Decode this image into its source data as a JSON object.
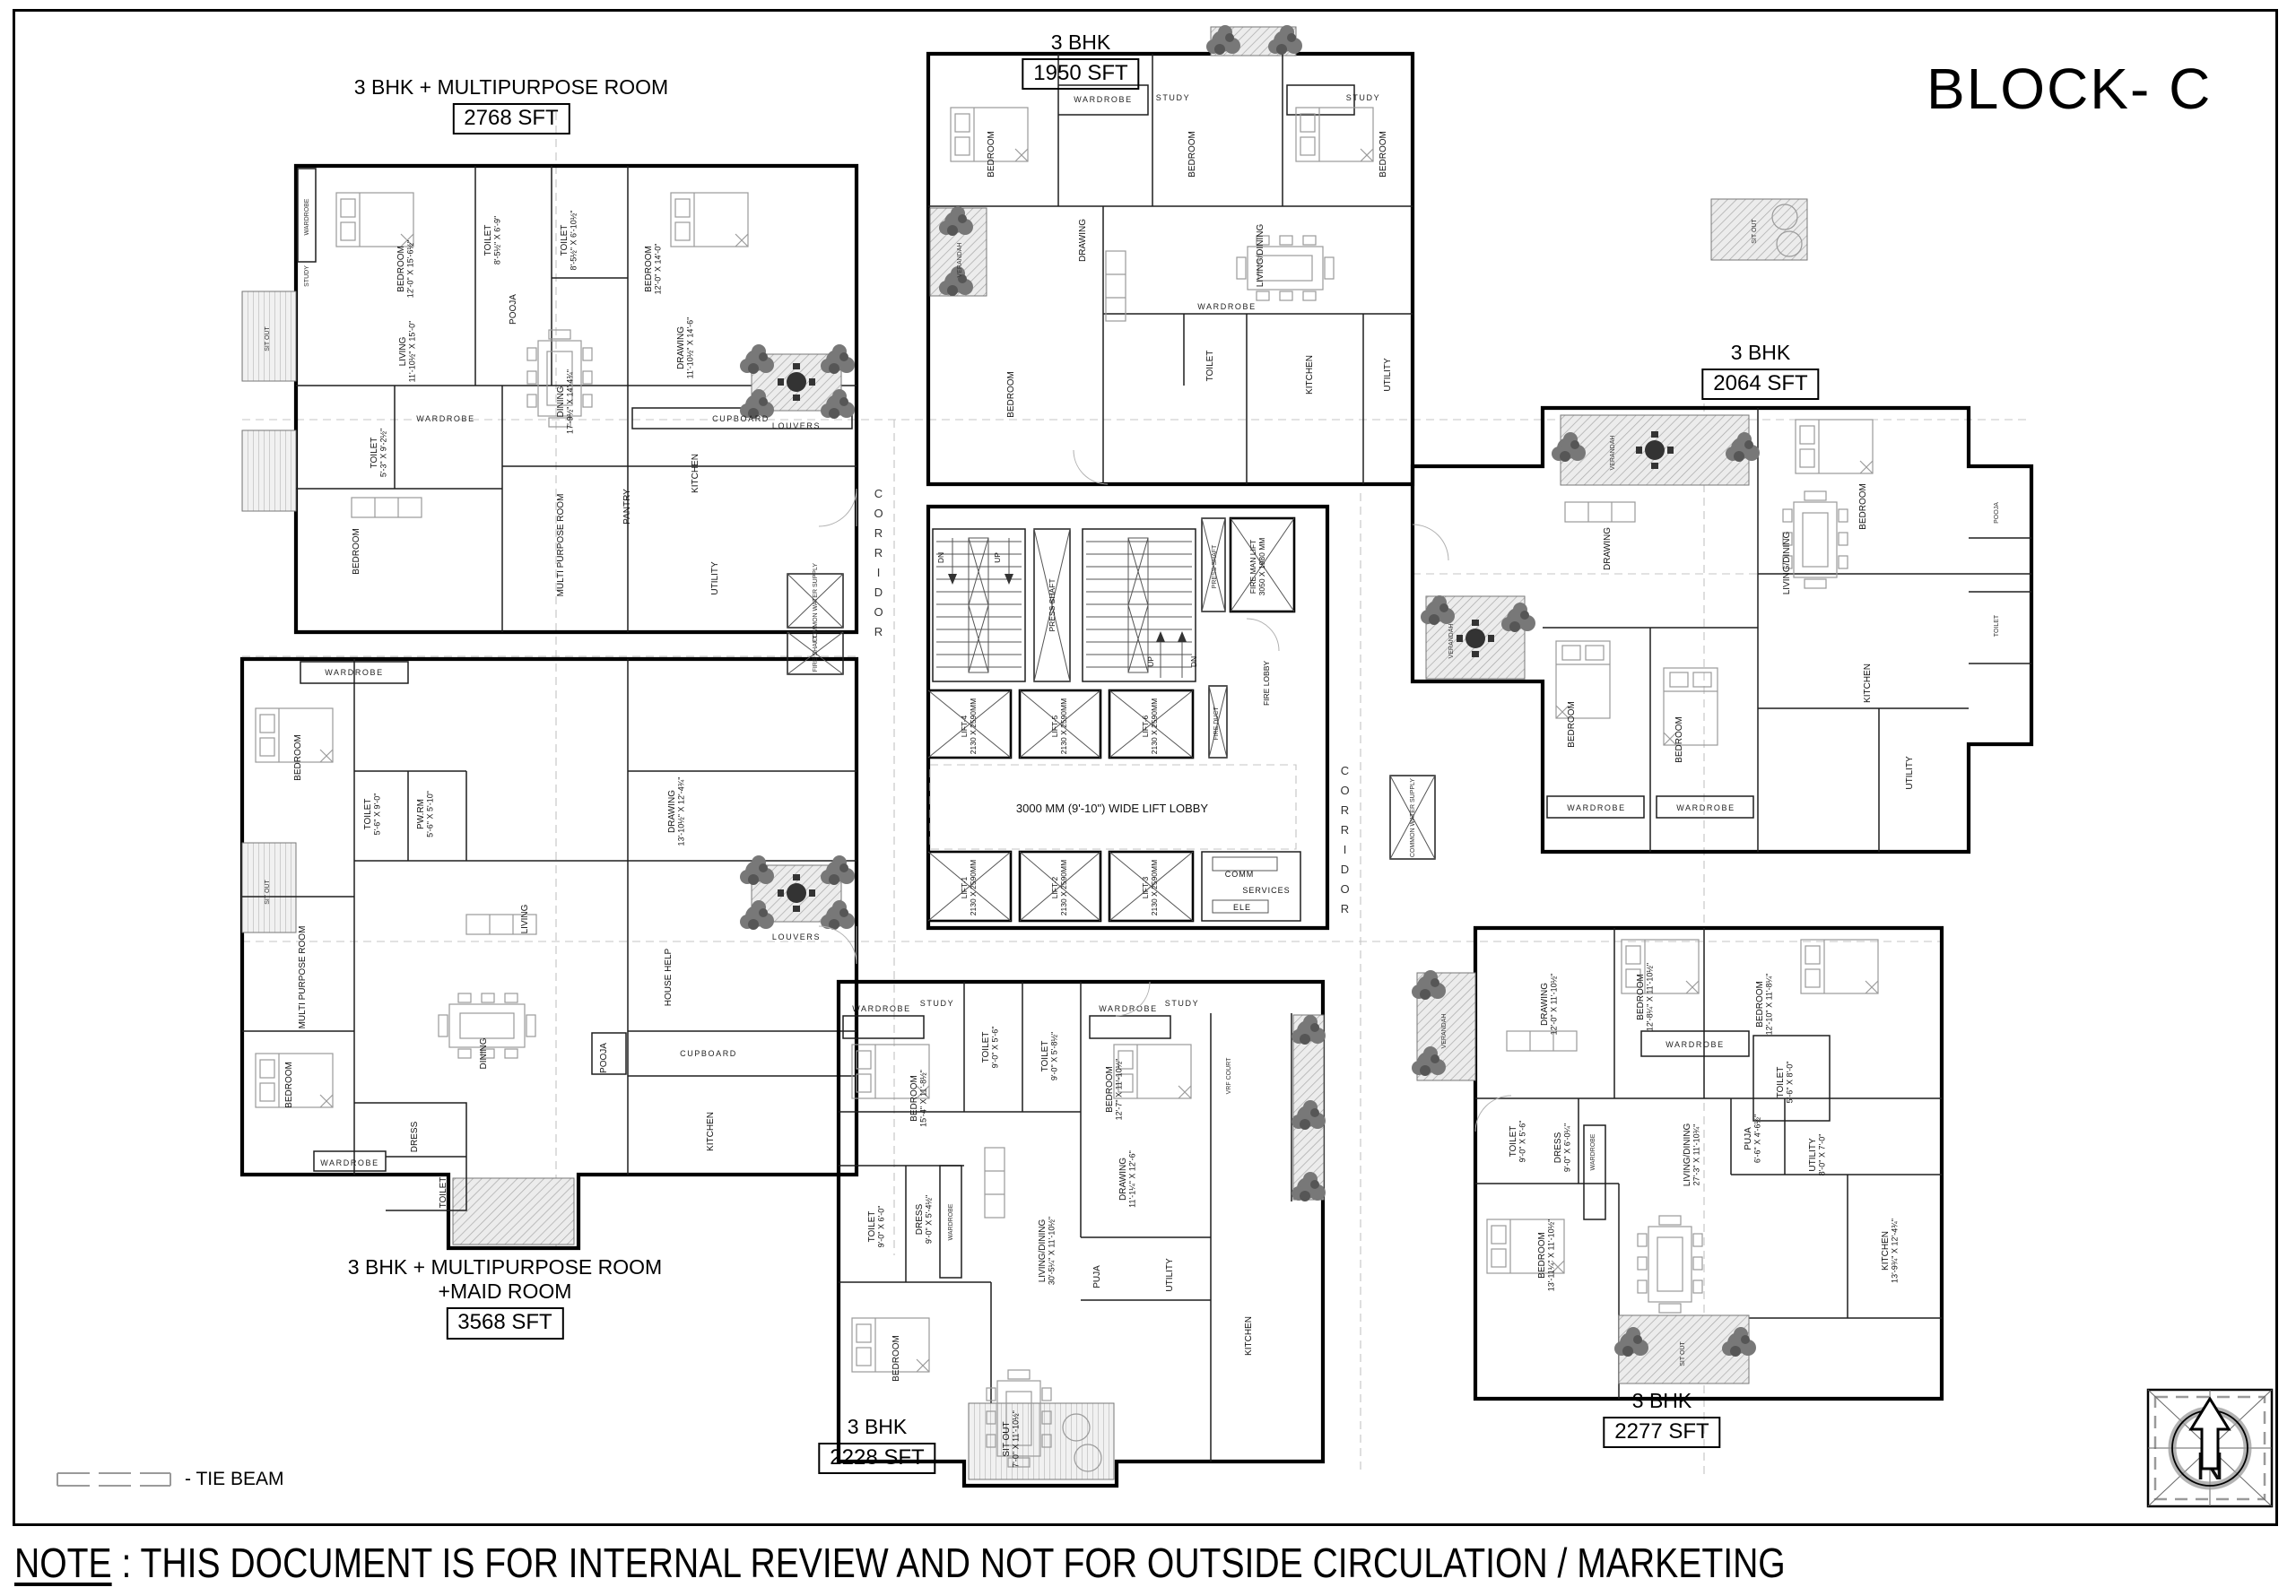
{
  "title": "BLOCK- C",
  "note": {
    "prefix": "NOTE",
    "text": " : THIS DOCUMENT IS FOR INTERNAL REVIEW AND NOT FOR OUTSIDE CIRCULATION / MARKETING"
  },
  "legend": {
    "tie_beam": "- TIE BEAM"
  },
  "compass": {
    "north": "N"
  },
  "unit_labels": {
    "u1": {
      "line1": "3 BHK + MULTIPURPOSE ROOM",
      "sft": "2768 SFT"
    },
    "u2": {
      "line1": "3 BHK + MULTIPURPOSE ROOM",
      "line2": "+MAID ROOM",
      "sft": "3568 SFT"
    },
    "u3": {
      "line1": "3 BHK",
      "sft": "1950 SFT"
    },
    "u4": {
      "line1": "3 BHK",
      "sft": "2064 SFT"
    },
    "u5": {
      "line1": "3 BHK",
      "sft": "2228 SFT"
    },
    "u6": {
      "line1": "3 BHK",
      "sft": "2277 SFT"
    }
  },
  "core": {
    "press_shaft": "PRESS SHAFT",
    "fire_man_lift": "FIRE MAN LIFT",
    "fire_man_lift_size": "3050 X 1980 MM",
    "fire_lobby": "FIRE LOBBY",
    "fire_duct": "FIRE DUCT",
    "lobby": "3000 MM (9'-10\") WIDE LIFT LOBBY",
    "corridor": "CORRIDOR",
    "common_water_supply": "COMMON WATER SUPPLY",
    "fire_shaft": "FIRE SHAFT",
    "comm": "COMM",
    "services": "SERVICES",
    "ele": "ELE",
    "up": "UP",
    "dn": "DN",
    "lifts": [
      {
        "name": "LIFT-1",
        "size": "2130 X 2590MM"
      },
      {
        "name": "LIFT-2",
        "size": "2130 X 2590MM"
      },
      {
        "name": "LIFT-3",
        "size": "2130 X 2590MM"
      },
      {
        "name": "LIFT-4",
        "size": "2130 X 2590MM"
      },
      {
        "name": "LIFT-5",
        "size": "2130 X 2590MM"
      },
      {
        "name": "LIFT-6",
        "size": "2130 X 2590MM"
      }
    ]
  },
  "rooms": {
    "u1": [
      {
        "name": "BEDROOM",
        "dim": "12'-0\" X 15'-6½\""
      },
      {
        "name": "TOILET",
        "dim": "8'-5½\" X 6'-9\""
      },
      {
        "name": "POOJA",
        "dim": ""
      },
      {
        "name": "TOILET",
        "dim": "8'-5½\" X 6'-10½\""
      },
      {
        "name": "BEDROOM",
        "dim": "12'-0\" X 14'-0\""
      },
      {
        "name": "LIVING",
        "dim": "11'-10½\" X 15'-0\""
      },
      {
        "name": "DINING",
        "dim": "17'-9½\" X 14'-4¾\""
      },
      {
        "name": "DRAWING",
        "dim": "11'-10½\" X 14'-6\""
      },
      {
        "name": "WARDROBE",
        "dim": ""
      },
      {
        "name": "STUDY",
        "dim": ""
      },
      {
        "name": "WARDROBE",
        "dim": ""
      },
      {
        "name": "TOILET",
        "dim": "5'-3\" X 9'-2½\""
      },
      {
        "name": "BEDROOM",
        "dim": ""
      },
      {
        "name": "MULTI PURPOSE ROOM",
        "dim": ""
      },
      {
        "name": "PANTRY",
        "dim": ""
      },
      {
        "name": "KITCHEN",
        "dim": ""
      },
      {
        "name": "CUPBOARD",
        "dim": ""
      },
      {
        "name": "UTILITY",
        "dim": ""
      },
      {
        "name": "SIT OUT",
        "dim": ""
      },
      {
        "name": "LOUVERS",
        "dim": ""
      }
    ],
    "u2": [
      {
        "name": "WARDROBE",
        "dim": ""
      },
      {
        "name": "BEDROOM",
        "dim": ""
      },
      {
        "name": "TOILET",
        "dim": "5'-6\" X 9'-0\""
      },
      {
        "name": "PW.RM",
        "dim": "5'-6\" X 5'-10\""
      },
      {
        "name": "DRAWING",
        "dim": "13'-10½\" X 12'-4¾\""
      },
      {
        "name": "MULTI PURPOSE ROOM",
        "dim": ""
      },
      {
        "name": "LIVING",
        "dim": ""
      },
      {
        "name": "HOUSE HELP",
        "dim": ""
      },
      {
        "name": "DINING",
        "dim": ""
      },
      {
        "name": "POOJA",
        "dim": ""
      },
      {
        "name": "CUPBOARD",
        "dim": ""
      },
      {
        "name": "KITCHEN",
        "dim": ""
      },
      {
        "name": "BEDROOM",
        "dim": ""
      },
      {
        "name": "DRESS",
        "dim": ""
      },
      {
        "name": "TOILET",
        "dim": ""
      },
      {
        "name": "WARDROBE",
        "dim": ""
      },
      {
        "name": "SIT OUT",
        "dim": ""
      },
      {
        "name": "LOUVERS",
        "dim": ""
      }
    ],
    "u3": [
      {
        "name": "WARDROBE",
        "dim": ""
      },
      {
        "name": "STUDY",
        "dim": ""
      },
      {
        "name": "BEDROOM",
        "dim": ""
      },
      {
        "name": "STUDY",
        "dim": ""
      },
      {
        "name": "BEDROOM",
        "dim": ""
      },
      {
        "name": "VERANDAH",
        "dim": ""
      },
      {
        "name": "DRAWING",
        "dim": ""
      },
      {
        "name": "LIVING/DINING",
        "dim": ""
      },
      {
        "name": "WARDROBE",
        "dim": ""
      },
      {
        "name": "BEDROOM",
        "dim": ""
      },
      {
        "name": "TOILET",
        "dim": ""
      },
      {
        "name": "KITCHEN",
        "dim": ""
      },
      {
        "name": "UTILITY",
        "dim": ""
      },
      {
        "name": "BEDROOM",
        "dim": ""
      }
    ],
    "u4": [
      {
        "name": "SIT OUT",
        "dim": ""
      },
      {
        "name": "VERANDAH",
        "dim": ""
      },
      {
        "name": "DRAWING",
        "dim": ""
      },
      {
        "name": "LIVING/DINING",
        "dim": ""
      },
      {
        "name": "BEDROOM",
        "dim": ""
      },
      {
        "name": "POOJA",
        "dim": ""
      },
      {
        "name": "TOILET",
        "dim": ""
      },
      {
        "name": "KITCHEN",
        "dim": ""
      },
      {
        "name": "UTILITY",
        "dim": ""
      },
      {
        "name": "BEDROOM",
        "dim": ""
      },
      {
        "name": "BEDROOM",
        "dim": ""
      },
      {
        "name": "WARDROBE",
        "dim": ""
      },
      {
        "name": "WARDROBE",
        "dim": ""
      },
      {
        "name": "VERANDAH",
        "dim": ""
      }
    ],
    "u5": [
      {
        "name": "WARDROBE",
        "dim": ""
      },
      {
        "name": "STUDY",
        "dim": ""
      },
      {
        "name": "BEDROOM",
        "dim": "15'-4\" X 11'-8½\""
      },
      {
        "name": "TOILET",
        "dim": "9'-0\" X 5'-6\""
      },
      {
        "name": "TOILET",
        "dim": "9'-0\" X 5'-8½\""
      },
      {
        "name": "WARDROBE",
        "dim": ""
      },
      {
        "name": "STUDY",
        "dim": ""
      },
      {
        "name": "BEDROOM",
        "dim": "12'-7\" X 11'-10½\""
      },
      {
        "name": "VRF COURT",
        "dim": ""
      },
      {
        "name": "DRAWING",
        "dim": "11'-1¼\" X 12'-6\""
      },
      {
        "name": "TOILET",
        "dim": "9'-0\" X 6'-0\""
      },
      {
        "name": "DRESS",
        "dim": "9'-0\" X 5'-4½\""
      },
      {
        "name": "WARDROBE",
        "dim": ""
      },
      {
        "name": "LIVING/DINING",
        "dim": "30'-5¼\" X 11'-10½\""
      },
      {
        "name": "PUJA",
        "dim": ""
      },
      {
        "name": "UTILITY",
        "dim": ""
      },
      {
        "name": "KITCHEN",
        "dim": ""
      },
      {
        "name": "BEDROOM",
        "dim": ""
      },
      {
        "name": "SIT OUT",
        "dim": "7'-0\" X 11'-10½\""
      }
    ],
    "u6": [
      {
        "name": "VERANDAH",
        "dim": ""
      },
      {
        "name": "DRAWING",
        "dim": "12'-0\" X 11'-10½\""
      },
      {
        "name": "BEDROOM",
        "dim": "12'-8¼\" X 11'-10½\""
      },
      {
        "name": "BEDROOM",
        "dim": "12'-10\" X 11'-8¼\""
      },
      {
        "name": "WARDROBE",
        "dim": ""
      },
      {
        "name": "TOILET",
        "dim": "5'-6\" X 8'-0\""
      },
      {
        "name": "TOILET",
        "dim": "9'-0\" X 5'-6\""
      },
      {
        "name": "DRESS",
        "dim": "9'-0\" X 6'-0¼\""
      },
      {
        "name": "WARDROBE",
        "dim": ""
      },
      {
        "name": "LIVING/DINING",
        "dim": "27'-3\" X 11'-10¾\""
      },
      {
        "name": "PUJA",
        "dim": "6'-6\" X 4'-6½\""
      },
      {
        "name": "UTILITY",
        "dim": "8'-0\" X 7'-0\""
      },
      {
        "name": "KITCHEN",
        "dim": "13'-9¾\" X 12'-4¾\""
      },
      {
        "name": "BEDROOM",
        "dim": "13'-11¼\" X 11'-10½\""
      },
      {
        "name": "SIT OUT",
        "dim": ""
      }
    ]
  }
}
